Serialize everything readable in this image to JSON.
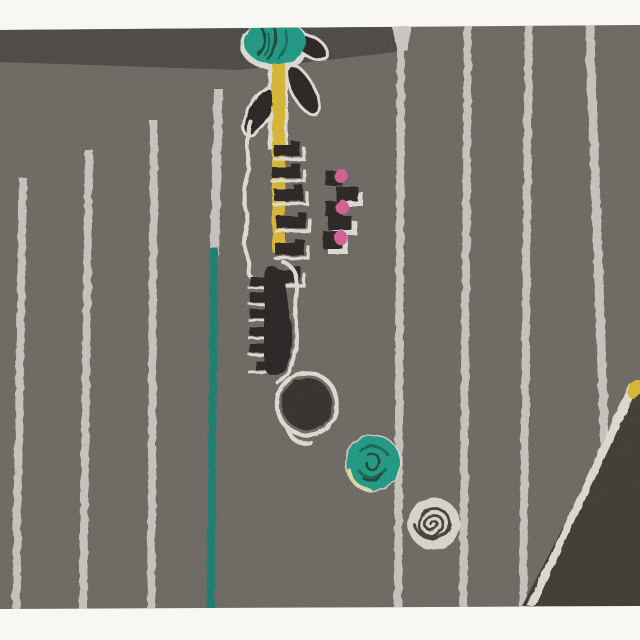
{
  "meta": {
    "kind": "photograph-of-artwork",
    "description": "Abstract modernist print: warm charcoal field with hand-pulled white pinstripes, a stylized flower with teal bloom, black leaves and yellow stem, black ladder and comb motifs with pink accents, a black dot, a teal dot, a white spiral stamp, a teal pinstripe, and a dark diagonal wedge with a yellow tip; white photo margins top and bottom."
  },
  "palette": {
    "paper": "#f8f7f3",
    "bg": "#6f6b63",
    "band": "#46443f",
    "stripe": "#dad7d0",
    "stripe_teal": "#0f8672",
    "ink": "#221f1a",
    "ink_soft": "#2d2a25",
    "white_ink": "#efece2",
    "teal": "#17a189",
    "teal_deep": "#0c6b52",
    "scribble_dark": "#123f34",
    "yellow": "#e9c32e",
    "pink": "#e55f9e",
    "wedge": "#3a372d",
    "spiral_fill": "#eae7db",
    "spiral_line": "#413d35",
    "pale_rim": "#e9e9b2"
  },
  "stripes": [
    {
      "x_top": 19,
      "y_top": 178,
      "x_bot": 12,
      "y_bot": 610,
      "w": 8,
      "color": "stripe"
    },
    {
      "x_top": 85,
      "y_top": 150,
      "x_bot": 79,
      "y_bot": 610,
      "w": 8,
      "color": "stripe"
    },
    {
      "x_top": 150,
      "y_top": 121,
      "x_bot": 147,
      "y_bot": 610,
      "w": 8,
      "color": "stripe"
    },
    {
      "x_top": 214,
      "y_top": 89,
      "x_bot": 210,
      "y_bot": 256,
      "w": 9,
      "color": "stripe"
    },
    {
      "x_top": 210,
      "y_top": 248,
      "x_bot": 207,
      "y_bot": 610,
      "w": 8,
      "color": "stripe_teal"
    },
    {
      "x_top": 397,
      "y_top": 46,
      "x_bot": 394,
      "y_bot": 610,
      "w": 8,
      "color": "stripe"
    },
    {
      "x_top": 464,
      "y_top": 24,
      "x_bot": 459,
      "y_bot": 610,
      "w": 8,
      "color": "stripe"
    },
    {
      "x_top": 525,
      "y_top": 24,
      "x_bot": 519,
      "y_bot": 610,
      "w": 8,
      "color": "stripe"
    },
    {
      "x_top": 585,
      "y_top": 24,
      "x_bot": 603,
      "y_bot": 520,
      "w": 9,
      "color": "stripe"
    }
  ],
  "ladder": {
    "rungs": [
      {
        "x": 274,
        "y": 141,
        "w": 26,
        "h": 15
      },
      {
        "x": 272,
        "y": 163,
        "w": 28,
        "h": 15
      },
      {
        "x": 274,
        "y": 185,
        "w": 29,
        "h": 16
      },
      {
        "x": 276,
        "y": 212,
        "w": 30,
        "h": 16
      },
      {
        "x": 275,
        "y": 239,
        "w": 29,
        "h": 16
      },
      {
        "x": 266,
        "y": 266,
        "w": 34,
        "h": 17
      }
    ]
  },
  "pink_ladder": {
    "blocks": [
      {
        "x": 326,
        "y": 171,
        "w": 17,
        "h": 15,
        "pink": {
          "cx": 341,
          "cy": 176
        },
        "white": false
      },
      {
        "x": 336,
        "y": 187,
        "w": 22,
        "h": 14,
        "pink": null,
        "white": true
      },
      {
        "x": 325,
        "y": 201,
        "w": 18,
        "h": 15,
        "pink": {
          "cx": 342,
          "cy": 207
        },
        "white": false
      },
      {
        "x": 328,
        "y": 216,
        "w": 24,
        "h": 14,
        "pink": null,
        "white": true
      },
      {
        "x": 323,
        "y": 231,
        "w": 20,
        "h": 18,
        "pink": {
          "cx": 341,
          "cy": 238
        },
        "white": true
      }
    ]
  },
  "comb": {
    "teeth_y": [
      277,
      293,
      309,
      327,
      344,
      361
    ],
    "tooth_x": 250,
    "tooth_w": 17,
    "tooth_h": 9
  }
}
